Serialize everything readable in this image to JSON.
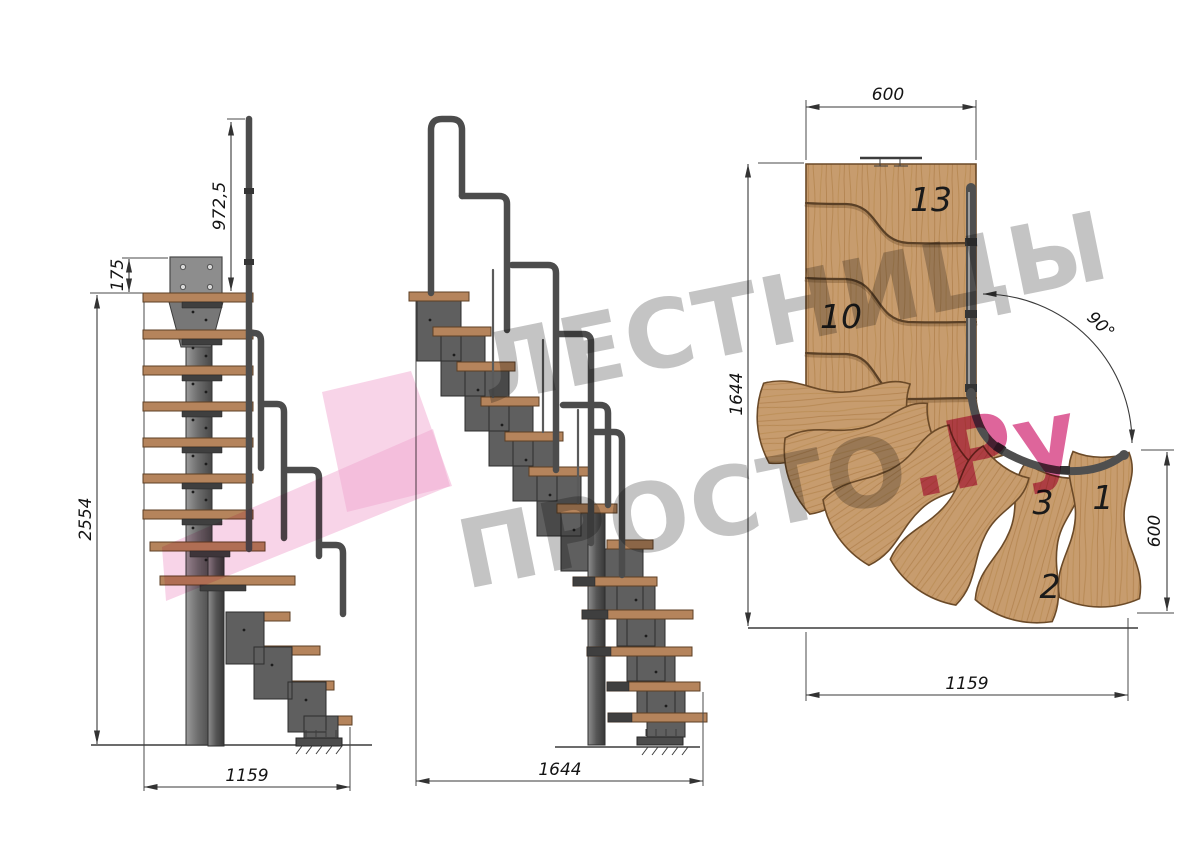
{
  "watermark": {
    "line1": "ЛЕСТНИЦЫ",
    "line2_gray": "ПРОСТО",
    "line2_pink": ".Ру"
  },
  "side_view_a": {
    "handrail_height": "972,5",
    "bracket_height": "175",
    "total_height": "2554",
    "total_run": "1159"
  },
  "side_view_b": {
    "total_run": "1644"
  },
  "plan_view": {
    "top_width": "600",
    "left_depth": "1644",
    "turn_angle": "90°",
    "right_depth": "600",
    "bottom_width": "1159",
    "steps": {
      "s13": "13",
      "s10": "10",
      "s3": "3",
      "s1": "1",
      "s2": "2"
    }
  },
  "colors": {
    "wood_side": "#b5845c",
    "wood_plan": "#c79c6e",
    "steel_rail": "#4c4c4c",
    "dim_line": "#3a3a3a",
    "watermark_gray": "#8a8a8a",
    "watermark_pink": "#d84a89",
    "watermark_arrow": "#f2a9d2"
  }
}
